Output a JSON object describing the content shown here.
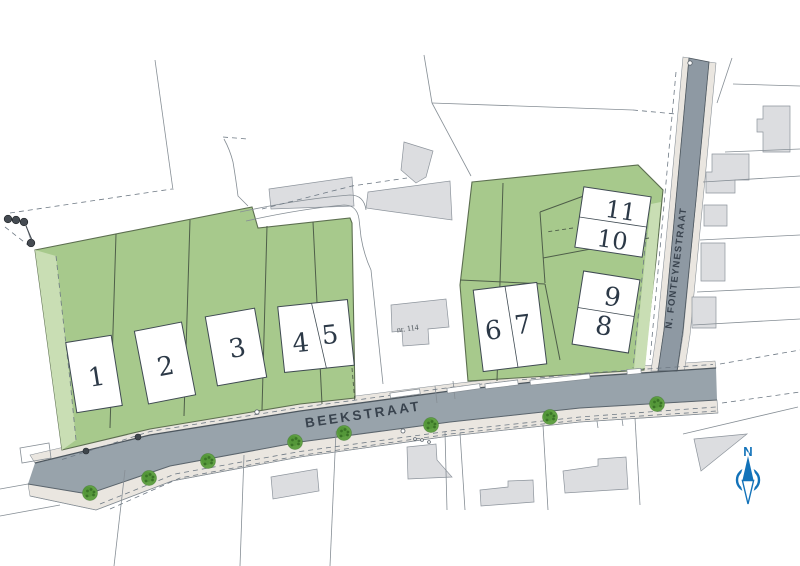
{
  "plan": {
    "streets": {
      "main": "BEEKSTRAAT",
      "side": "N. FONTEYNESTRAAT"
    },
    "existing_building_label": "nr. 114",
    "compass_label": "N",
    "lots": [
      {
        "id": "1",
        "box": {
          "cx": 94,
          "cy": 374,
          "w": 46,
          "h": 71,
          "rot": -9
        },
        "divider": null,
        "num_size": 26,
        "numbers": [
          {
            "text": "1",
            "dx": 2,
            "dy": 12
          }
        ]
      },
      {
        "id": "2",
        "box": {
          "cx": 165,
          "cy": 363,
          "w": 48,
          "h": 74,
          "rot": -11
        },
        "divider": null,
        "num_size": 26,
        "numbers": [
          {
            "text": "2",
            "dx": 0,
            "dy": 12
          }
        ]
      },
      {
        "id": "3",
        "box": {
          "cx": 236,
          "cy": 347,
          "w": 50,
          "h": 70,
          "rot": -10
        },
        "divider": null,
        "num_size": 26,
        "numbers": [
          {
            "text": "3",
            "dx": 1,
            "dy": 10
          }
        ]
      },
      {
        "id": "4-5",
        "box": {
          "cx": 316,
          "cy": 336,
          "w": 70,
          "h": 66,
          "rot": -6
        },
        "divider": "v",
        "dsk": [
          -1,
          7
        ],
        "num_size": 26,
        "numbers": [
          {
            "text": "4",
            "dx": -16,
            "dy": 14
          },
          {
            "text": "5",
            "dx": 14,
            "dy": 9
          }
        ]
      },
      {
        "id": "6-7",
        "box": {
          "cx": 510,
          "cy": 327,
          "w": 64,
          "h": 82,
          "rot": -7
        },
        "divider": "v",
        "dsk": [
          0,
          3
        ],
        "num_size": 26,
        "numbers": [
          {
            "text": "6",
            "dx": -17,
            "dy": 10
          },
          {
            "text": "7",
            "dx": 13,
            "dy": 8
          }
        ]
      },
      {
        "id": "8-9",
        "box": {
          "cx": 606,
          "cy": 312,
          "w": 57,
          "h": 74,
          "rot": 9
        },
        "divider": "h",
        "dsk": [
          0,
          0
        ],
        "num_size": 26,
        "numbers": [
          {
            "text": "9",
            "dx": 4,
            "dy": -7
          },
          {
            "text": "8",
            "dx": 0,
            "dy": 23
          }
        ]
      },
      {
        "id": "10-11",
        "box": {
          "cx": 613,
          "cy": 222,
          "w": 68,
          "h": 61,
          "rot": 8.5
        },
        "divider": "h",
        "dsk": [
          0,
          0
        ],
        "num_size": 24,
        "numbers": [
          {
            "text": "11",
            "dx": 6,
            "dy": -4
          },
          {
            "text": "10",
            "dx": 2,
            "dy": 26
          }
        ]
      }
    ],
    "trees": [
      [
        90,
        493
      ],
      [
        149,
        478
      ],
      [
        208,
        461
      ],
      [
        295,
        442
      ],
      [
        344,
        433
      ],
      [
        431,
        425
      ],
      [
        550,
        417
      ],
      [
        657,
        404
      ]
    ],
    "utility_dots": [
      [
        86,
        451
      ],
      [
        138,
        437
      ]
    ],
    "pole_markers": [
      [
        8,
        219
      ],
      [
        16,
        220
      ],
      [
        24,
        222
      ],
      [
        31,
        243
      ]
    ],
    "small_circles": [
      [
        257,
        412,
        2.2
      ],
      [
        403,
        431,
        2.0
      ],
      [
        690,
        63,
        2.2
      ],
      [
        415,
        439,
        1.4
      ],
      [
        422,
        440,
        1.4
      ],
      [
        429,
        442,
        1.4
      ]
    ],
    "colors": {
      "road": "#98a3ab",
      "roadF": "#8e99a3",
      "roadEdge": "#4d575f",
      "walk": "#eae6e0",
      "green": "#a7c98c",
      "greenLight": "#c9deb4",
      "greenEdge": "#5c6e50",
      "greenDiv": "#4e5e49",
      "bld": "#dcdde0",
      "bldEdge": "#8d949c",
      "lineThin": "#868e95",
      "lineDash": "#6e7984",
      "boxEdge": "#3f4a52",
      "numColor": "#2c3947",
      "labelColor": "#39434e",
      "compass": "#1272b9",
      "tree1": "#61a144",
      "tree2": "#549739",
      "tree3": "#3a7427",
      "dot": "#3f464c"
    }
  }
}
